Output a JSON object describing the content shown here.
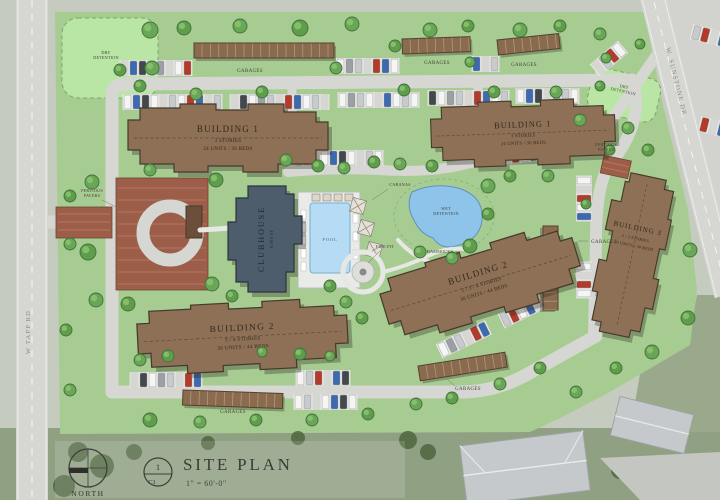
{
  "drawing": {
    "title": "SITE PLAN",
    "scale": "1\" = 60'-0\"",
    "north_label": "NORTH",
    "sheet_number": "1",
    "sheet_ref": "C1"
  },
  "streets": {
    "west": "W TAPP RD",
    "northeast": "W. SUNSTONE DR"
  },
  "buildings": [
    {
      "name": "BUILDING 1",
      "stories": "3 STORIES",
      "units": "24 UNITS / 36 BEDS"
    },
    {
      "name": "BUILDING 1",
      "stories": "3 STORIES",
      "units": "24 UNITS / 36 BEDS"
    },
    {
      "name": "BUILDING 2",
      "stories": "2 / 3 / 4 STORIES",
      "units": "36 UNITS / 44 BEDS"
    },
    {
      "name": "BUILDING 2",
      "stories": "3 / 4 STORIES",
      "units": "36 UNITS / 44 BEDS"
    },
    {
      "name": "BUILDING 3",
      "stories": "2 / 3 STORIES",
      "units": "20 UNITS / 30 BEDS"
    },
    {
      "name": "CLUBHOUSE",
      "area": "8,000 SF"
    }
  ],
  "site_labels": {
    "garages": "GARAGES",
    "pervious_pavers": "PERVIOUS\nPAVERS",
    "dry_detention": "DRY\nDETENTION",
    "wet_detention": "WET\nDETENTION",
    "pool": "POOL",
    "cabanas": "CABANAS",
    "fire_pit": "FIRE PIT",
    "hammocks": "HAMMOCKS"
  },
  "colors": {
    "site_green": "#a6cc92",
    "detention_green": "#b9e6a4",
    "road_gray": "#d6d7d3",
    "building_brown": "#8d7055",
    "building_outline": "#463a2b",
    "garage_brown": "#8a6b4d",
    "clubhouse_slate": "#4d5d6c",
    "pool_blue": "#b5dcf4",
    "pond_blue": "#8fc4ea",
    "paver_red": "#9c5e49",
    "aerial_green": "#90a083",
    "offsite_roof": "#c6c9cb",
    "car_palette": [
      "#f4f5f4",
      "#c7cbce",
      "#b23b2c",
      "#f4f5f4",
      "#3c69b0",
      "#43484d",
      "#f4f5f4",
      "#9aa0a5",
      "#c7cbce",
      "#f4f5f4",
      "#b23b2c",
      "#3c69b0",
      "#f4f5f4",
      "#c7cbce"
    ]
  }
}
